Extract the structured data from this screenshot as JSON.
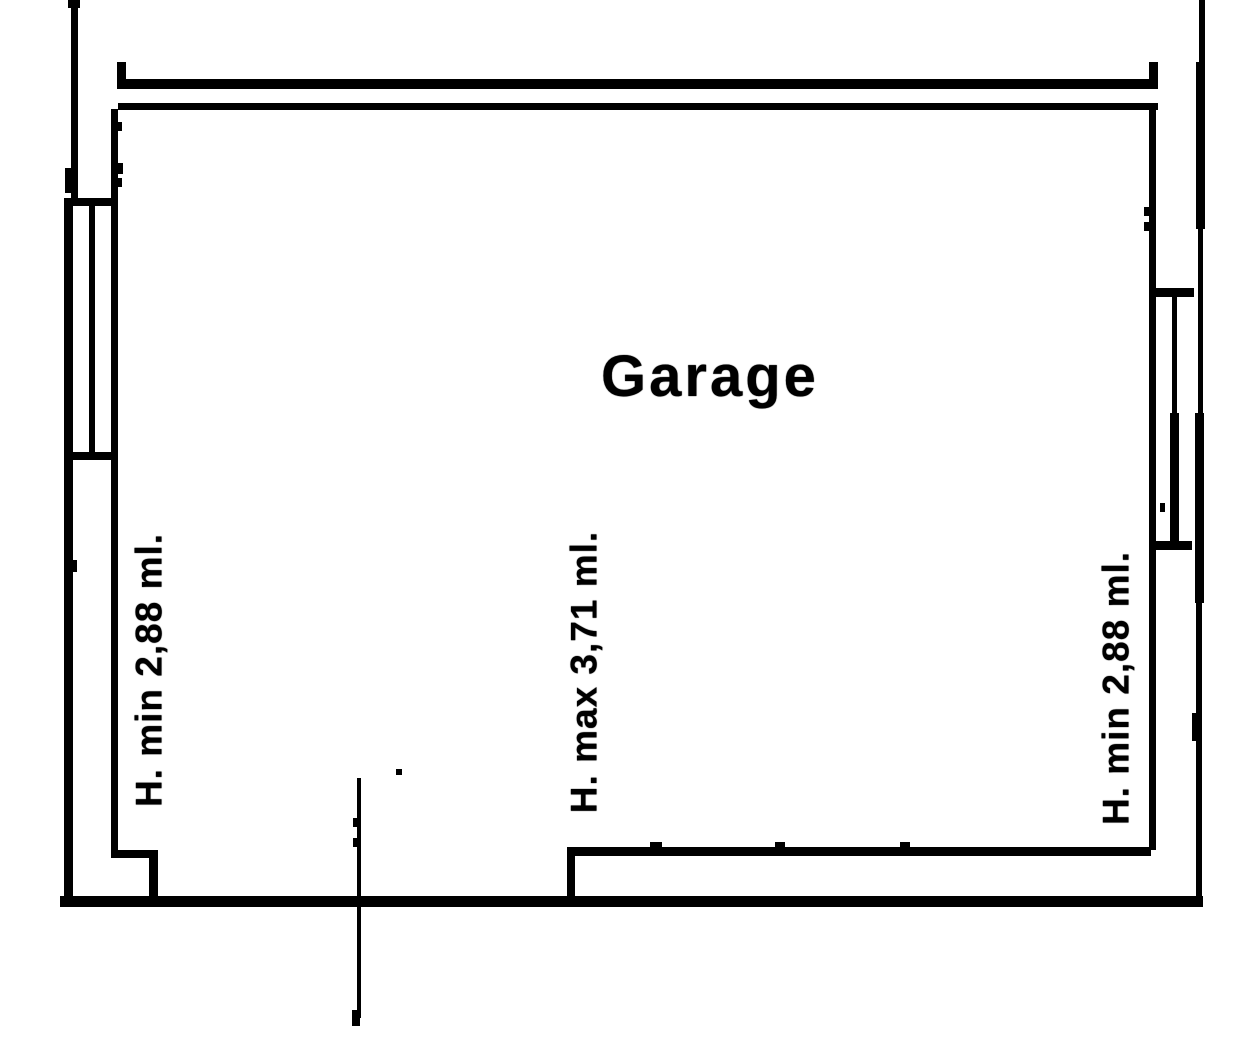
{
  "document": {
    "kind": "scanned floor plan drawing",
    "colors": {
      "line": "#000000",
      "background": "#ffffff"
    }
  },
  "plan": {
    "room_label": "Garage",
    "height_annotations": [
      {
        "id": "left",
        "text": "H. min 2,88 ml."
      },
      {
        "id": "center",
        "text": "H. max 3,71 ml."
      },
      {
        "id": "right",
        "text": "H. min 2,88 ml."
      }
    ]
  }
}
